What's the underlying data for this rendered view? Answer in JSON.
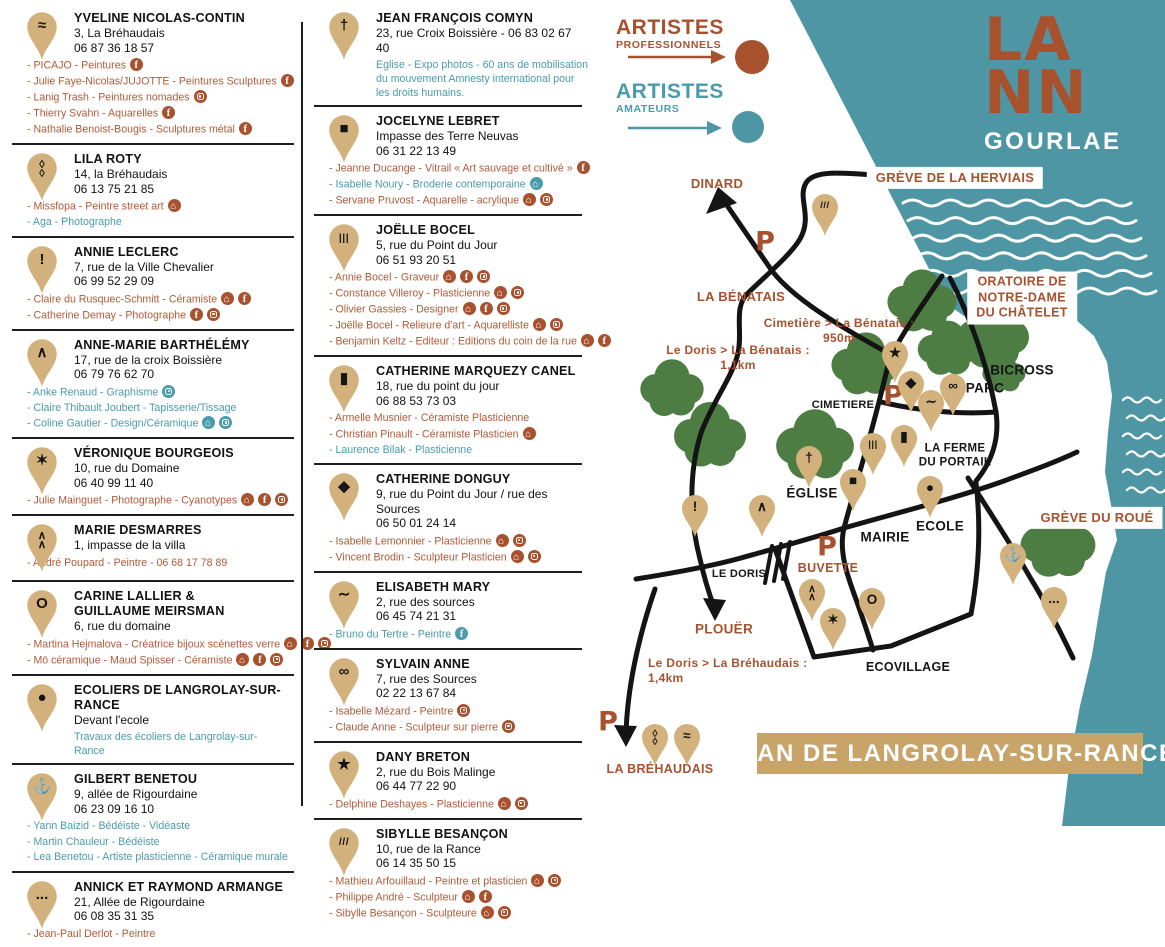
{
  "colors": {
    "rust": "#a8512e",
    "rust_text": "#b15a38",
    "teal_text": "#4a9bab",
    "water": "#4f96a4",
    "pin_tan": "#d3b17c",
    "tree_green": "#4e7d44",
    "banner_tan": "#c9a469",
    "road_black": "#141414"
  },
  "logo": {
    "l1": "LA",
    "l2": "NN",
    "l3": "GOURLAE"
  },
  "legend": {
    "professionals": [
      "ARTISTES",
      "PROFESSIONNELS"
    ],
    "amateurs": [
      "ARTISTES",
      "AMATEURS"
    ]
  },
  "banner": {
    "text": "PLAN DE LANGROLAY-SUR-RANCE"
  },
  "columns": [
    [
      {
        "pin": "≈",
        "name": "YVELINE NICOLAS-CONTIN",
        "address": "3, La Bréhaudais",
        "phone": "06 87 36 18 57",
        "artists": [
          {
            "text": "PICAJO - Peintures",
            "c": "rust",
            "ic": [
              "fb"
            ]
          },
          {
            "text": "Julie Faye-Nicolas/JUJOTTE - Peintures Sculptures",
            "c": "rust",
            "ic": [
              "fb"
            ]
          },
          {
            "text": "Lanig Trash - Peintures nomades",
            "c": "rust",
            "ic": [
              "ig"
            ]
          },
          {
            "text": "Thierry Svahn - Aquarelles",
            "c": "rust",
            "ic": [
              "fb"
            ]
          },
          {
            "text": "Nathalie Benoist-Bougis - Sculptures métal",
            "c": "rust",
            "ic": [
              "fb"
            ]
          }
        ]
      },
      {
        "pin": "◊\n◊",
        "name": "LILA ROTY",
        "address": "14, la Bréhaudais",
        "phone": "06 13 75 21 85",
        "artists": [
          {
            "text": "Missfopa - Peintre street art",
            "c": "rust",
            "ic": [
              "home"
            ]
          },
          {
            "text": "Aga - Photographe",
            "c": "teal",
            "ic": []
          }
        ]
      },
      {
        "pin": "!",
        "name": "ANNIE LECLERC",
        "address": "7, rue de la Ville Chevalier",
        "phone": "06 99 52 29 09",
        "artists": [
          {
            "text": "Claire du Rusquec-Schmitt - Céramiste",
            "c": "rust",
            "ic": [
              "home",
              "fb"
            ]
          },
          {
            "text": "Catherine Demay - Photographe",
            "c": "rust",
            "ic": [
              "fb",
              "ig"
            ]
          }
        ]
      },
      {
        "pin": "∧",
        "name": "ANNE-MARIE BARTHÉLÉMY",
        "address": "17, rue de la croix Boissière",
        "phone": "06 79 76 62 70",
        "artists": [
          {
            "text": "Anke Renaud - Graphisme",
            "c": "teal",
            "ic": [
              "ig"
            ]
          },
          {
            "text": "Claire Thibault Joubert - Tapisserie/Tissage",
            "c": "teal",
            "ic": []
          },
          {
            "text": "Coline Gautier - Design/Céramique",
            "c": "teal",
            "ic": [
              "home",
              "ig"
            ]
          }
        ]
      },
      {
        "pin": "✶",
        "name": "VÉRONIQUE BOURGEOIS",
        "address": "10, rue du Domaine",
        "phone": "06 40 99 11 40",
        "artists": [
          {
            "text": "Julie Mainguet - Photographe - Cyanotypes",
            "c": "rust",
            "ic": [
              "home",
              "fb",
              "ig"
            ]
          }
        ]
      },
      {
        "pin": "∧\n∧",
        "name": "MARIE DESMARRES",
        "address": "1, impasse de la villa",
        "phone": "",
        "artists": [
          {
            "text": "André Poupard - Peintre - 06 68 17 78 89",
            "c": "rust",
            "ic": []
          }
        ]
      },
      {
        "pin": "O",
        "name": "CARINE LALLIER &\nGUILLAUME MEIRSMAN",
        "address": "6, rue du domaine",
        "phone": "",
        "artists": [
          {
            "text": "Martina Hejmalova - Créatrice bijoux scénettes verre",
            "c": "rust",
            "ic": [
              "home",
              "fb",
              "ig"
            ]
          },
          {
            "text": "Mö céramique - Maud Spisser - Céramiste",
            "c": "rust",
            "ic": [
              "home",
              "fb",
              "ig"
            ]
          }
        ]
      },
      {
        "pin": "●",
        "name": "ECOLIERS DE LANGROLAY-SUR-RANCE",
        "address": "Devant l'ecole",
        "phone": "",
        "artists": [
          {
            "text": "Travaux des écoliers de Langrolay-sur-Rance",
            "c": "teal",
            "ic": [],
            "indent": true
          }
        ]
      },
      {
        "pin": "⚓",
        "name": "GILBERT BENETOU",
        "address": "9, allée de Rigourdaine",
        "phone": "06 23 09 16 10",
        "artists": [
          {
            "text": "Yann Baizid - Bédéiste - Vidéaste",
            "c": "teal",
            "ic": []
          },
          {
            "text": "Martin Chauleur - Bédéiste",
            "c": "teal",
            "ic": []
          },
          {
            "text": "Lea Benetou - Artiste plasticienne - Céramique murale",
            "c": "teal",
            "ic": []
          }
        ]
      },
      {
        "pin": "...",
        "name": "ANNICK ET RAYMOND ARMANGE",
        "address": "21, Allée de Rigourdaine",
        "phone": "06 08 35 31 35",
        "artists": [
          {
            "text": "Jean-Paul Derlot - Peintre",
            "c": "rust",
            "ic": []
          }
        ]
      }
    ],
    [
      {
        "pin": "†",
        "name": "JEAN FRANÇOIS COMYN",
        "address": "23, rue Croix Boissière - 06 83 02 67 40",
        "phone": "",
        "artists": [
          {
            "text": "Eglise - Expo photos - 60 ans de mobilisation du mouvement Amnesty international pour les droits humains.",
            "c": "teal",
            "ic": [],
            "indent": true
          }
        ]
      },
      {
        "pin": "■",
        "name": "JOCELYNE LEBRET",
        "address": "Impasse des Terre Neuvas",
        "phone": "06 31 22 13 49",
        "artists": [
          {
            "text": "Jeanne Ducange - Vitrail « Art sauvage et cultivé »",
            "c": "rust",
            "ic": [
              "fb"
            ]
          },
          {
            "text": "Isabelle Noury - Broderie contemporaine",
            "c": "teal",
            "ic": [
              "home"
            ]
          },
          {
            "text": "Servane Pruvost - Aquarelle - acrylique",
            "c": "rust",
            "ic": [
              "home",
              "ig"
            ]
          }
        ]
      },
      {
        "pin": "|||",
        "name": "JOËLLE BOCEL",
        "address": "5, rue du Point du Jour",
        "phone": "06 51 93 20 51",
        "artists": [
          {
            "text": "Annie Bocel - Graveur",
            "c": "rust",
            "ic": [
              "home",
              "fb",
              "ig"
            ]
          },
          {
            "text": "Constance Villeroy - Plasticienne",
            "c": "rust",
            "ic": [
              "home",
              "ig"
            ]
          },
          {
            "text": "Olivier Gassies - Designer",
            "c": "rust",
            "ic": [
              "home",
              "fb",
              "ig"
            ]
          },
          {
            "text": "Joëlle Bocel - Relieure d'art - Aquarelliste",
            "c": "rust",
            "ic": [
              "home",
              "ig"
            ]
          },
          {
            "text": "Benjamin Keltz - Editeur : Editions du coin de la rue",
            "c": "rust",
            "ic": [
              "home",
              "fb"
            ]
          }
        ]
      },
      {
        "pin": "▮",
        "name": "CATHERINE MARQUEZY CANEL",
        "address": "18, rue du point du jour",
        "phone": "06 88 53 73 03",
        "artists": [
          {
            "text": "Armelle Musnier - Céramiste Plasticienne",
            "c": "rust",
            "ic": []
          },
          {
            "text": "Christian Pinault - Céramiste Plasticien",
            "c": "rust",
            "ic": [
              "home"
            ]
          },
          {
            "text": "Laurence Bilak - Plasticienne",
            "c": "teal",
            "ic": []
          }
        ]
      },
      {
        "pin": "◆",
        "name": "CATHERINE DONGUY",
        "address": "9, rue du Point du Jour / rue des Sources",
        "phone": "06 50 01 24 14",
        "artists": [
          {
            "text": "Isabelle Lemonnier - Plasticienne",
            "c": "rust",
            "ic": [
              "home",
              "ig"
            ]
          },
          {
            "text": "Vincent Brodin - Sculpteur Plasticien",
            "c": "rust",
            "ic": [
              "home",
              "ig"
            ]
          }
        ]
      },
      {
        "pin": "∼",
        "name": "ELISABETH MARY",
        "address": "2, rue des sources",
        "phone": "06 45 74 21 31",
        "artists": [
          {
            "text": "Bruno du Tertre - Peintre",
            "c": "teal",
            "ic": [
              "fb"
            ]
          }
        ]
      },
      {
        "pin": "∞",
        "name": "SYLVAIN ANNE",
        "address": "7, rue des Sources",
        "phone": "02 22 13 67 84",
        "artists": [
          {
            "text": "Isabelle Mézard - Peintre",
            "c": "rust",
            "ic": [
              "ig"
            ]
          },
          {
            "text": "Claude Anne - Sculpteur sur pierre",
            "c": "rust",
            "ic": [
              "ig"
            ]
          }
        ]
      },
      {
        "pin": "★",
        "name": "DANY BRETON",
        "address": "2, rue du Bois Malinge",
        "phone": "06 44 77 22 90",
        "artists": [
          {
            "text": "Delphine Deshayes - Plasticienne",
            "c": "rust",
            "ic": [
              "home",
              "ig"
            ]
          }
        ]
      },
      {
        "pin": "///",
        "name": "SIBYLLE BESANÇON",
        "address": "10, rue de la Rance",
        "phone": "06 14 35 50 15",
        "artists": [
          {
            "text": "Mathieu Arfouillaud - Peintre et plasticien",
            "c": "rust",
            "ic": [
              "home",
              "ig"
            ]
          },
          {
            "text": "Philippe André - Sculpteur",
            "c": "rust",
            "ic": [
              "home",
              "fb"
            ]
          },
          {
            "text": "Sibylle Besançon - Sculpteure",
            "c": "rust",
            "ic": [
              "home",
              "ig"
            ]
          }
        ]
      }
    ]
  ],
  "map": {
    "labels": [
      {
        "t": "DINARD",
        "x": 717,
        "y": 184,
        "c": "rust",
        "fs": 13
      },
      {
        "t": "GRÈVE DE LA HERVIAIS",
        "x": 955,
        "y": 178,
        "c": "rust",
        "fs": 13,
        "box": true
      },
      {
        "t": "LA BÉNATAIS",
        "x": 741,
        "y": 297,
        "c": "rust",
        "fs": 13
      },
      {
        "t": "Cimetière > La Bénatais :\n950m",
        "x": 839,
        "y": 331,
        "c": "rust",
        "fs": 12
      },
      {
        "t": "Le Doris > La Bénatais :\n1,1km",
        "x": 738,
        "y": 358,
        "c": "rust",
        "fs": 12
      },
      {
        "t": "ORATOIRE DE\nNOTRE-DAME\nDU CHÂTELET",
        "x": 1022,
        "y": 298,
        "c": "rust",
        "fs": 12.5,
        "box": true
      },
      {
        "t": "CIMETIERE",
        "x": 843,
        "y": 406,
        "c": "black",
        "fs": 11
      },
      {
        "t": "BICROSS",
        "x": 1022,
        "y": 371,
        "c": "black",
        "fs": 13.5
      },
      {
        "t": "PARC",
        "x": 985,
        "y": 389,
        "c": "black",
        "fs": 13.5
      },
      {
        "t": "LA FERME\nDU PORTAIL",
        "x": 955,
        "y": 456,
        "c": "black",
        "fs": 11.5
      },
      {
        "t": "ÉGLISE",
        "x": 812,
        "y": 494,
        "c": "black",
        "fs": 13.5
      },
      {
        "t": "MAIRIE",
        "x": 885,
        "y": 538,
        "c": "black",
        "fs": 13.5
      },
      {
        "t": "ECOLE",
        "x": 940,
        "y": 527,
        "c": "black",
        "fs": 13.5
      },
      {
        "t": "LE DORIS",
        "x": 739,
        "y": 575,
        "c": "black",
        "fs": 11
      },
      {
        "t": "BUVETTE",
        "x": 828,
        "y": 569,
        "c": "rust",
        "fs": 12.5
      },
      {
        "t": "PLOUËR",
        "x": 724,
        "y": 630,
        "c": "rust",
        "fs": 13.5
      },
      {
        "t": "Le Doris > La Bréhaudais :\n1,4km",
        "x": 648,
        "y": 671,
        "c": "rust",
        "fs": 12,
        "left": true
      },
      {
        "t": "LA BRÉHAUDAIS",
        "x": 660,
        "y": 770,
        "c": "rust",
        "fs": 12.5
      },
      {
        "t": "ECOVILLAGE",
        "x": 908,
        "y": 668,
        "c": "black",
        "fs": 12.5
      },
      {
        "t": "GRÈVE DU ROUÉ",
        "x": 1097,
        "y": 518,
        "c": "rust",
        "fs": 13,
        "box": true
      }
    ],
    "p_markers": [
      {
        "x": 765,
        "y": 242
      },
      {
        "x": 893,
        "y": 396
      },
      {
        "x": 827,
        "y": 547
      },
      {
        "x": 608,
        "y": 722
      }
    ],
    "pins": [
      {
        "x": 825,
        "y": 207,
        "g": "///"
      },
      {
        "x": 895,
        "y": 354,
        "g": "★"
      },
      {
        "x": 911,
        "y": 384,
        "g": "◆"
      },
      {
        "x": 953,
        "y": 387,
        "g": "∞"
      },
      {
        "x": 931,
        "y": 403,
        "g": "∼"
      },
      {
        "x": 873,
        "y": 446,
        "g": "|||"
      },
      {
        "x": 904,
        "y": 438,
        "g": "▮"
      },
      {
        "x": 809,
        "y": 459,
        "g": "†"
      },
      {
        "x": 853,
        "y": 482,
        "g": "■"
      },
      {
        "x": 930,
        "y": 489,
        "g": "●"
      },
      {
        "x": 695,
        "y": 508,
        "g": "!"
      },
      {
        "x": 762,
        "y": 508,
        "g": "∧"
      },
      {
        "x": 812,
        "y": 592,
        "g": "∧\n∧"
      },
      {
        "x": 833,
        "y": 621,
        "g": "✶"
      },
      {
        "x": 872,
        "y": 601,
        "g": "O"
      },
      {
        "x": 1013,
        "y": 556,
        "g": "⚓"
      },
      {
        "x": 1054,
        "y": 600,
        "g": "..."
      },
      {
        "x": 655,
        "y": 737,
        "g": "◊\n◊"
      },
      {
        "x": 687,
        "y": 737,
        "g": "≈"
      }
    ]
  }
}
